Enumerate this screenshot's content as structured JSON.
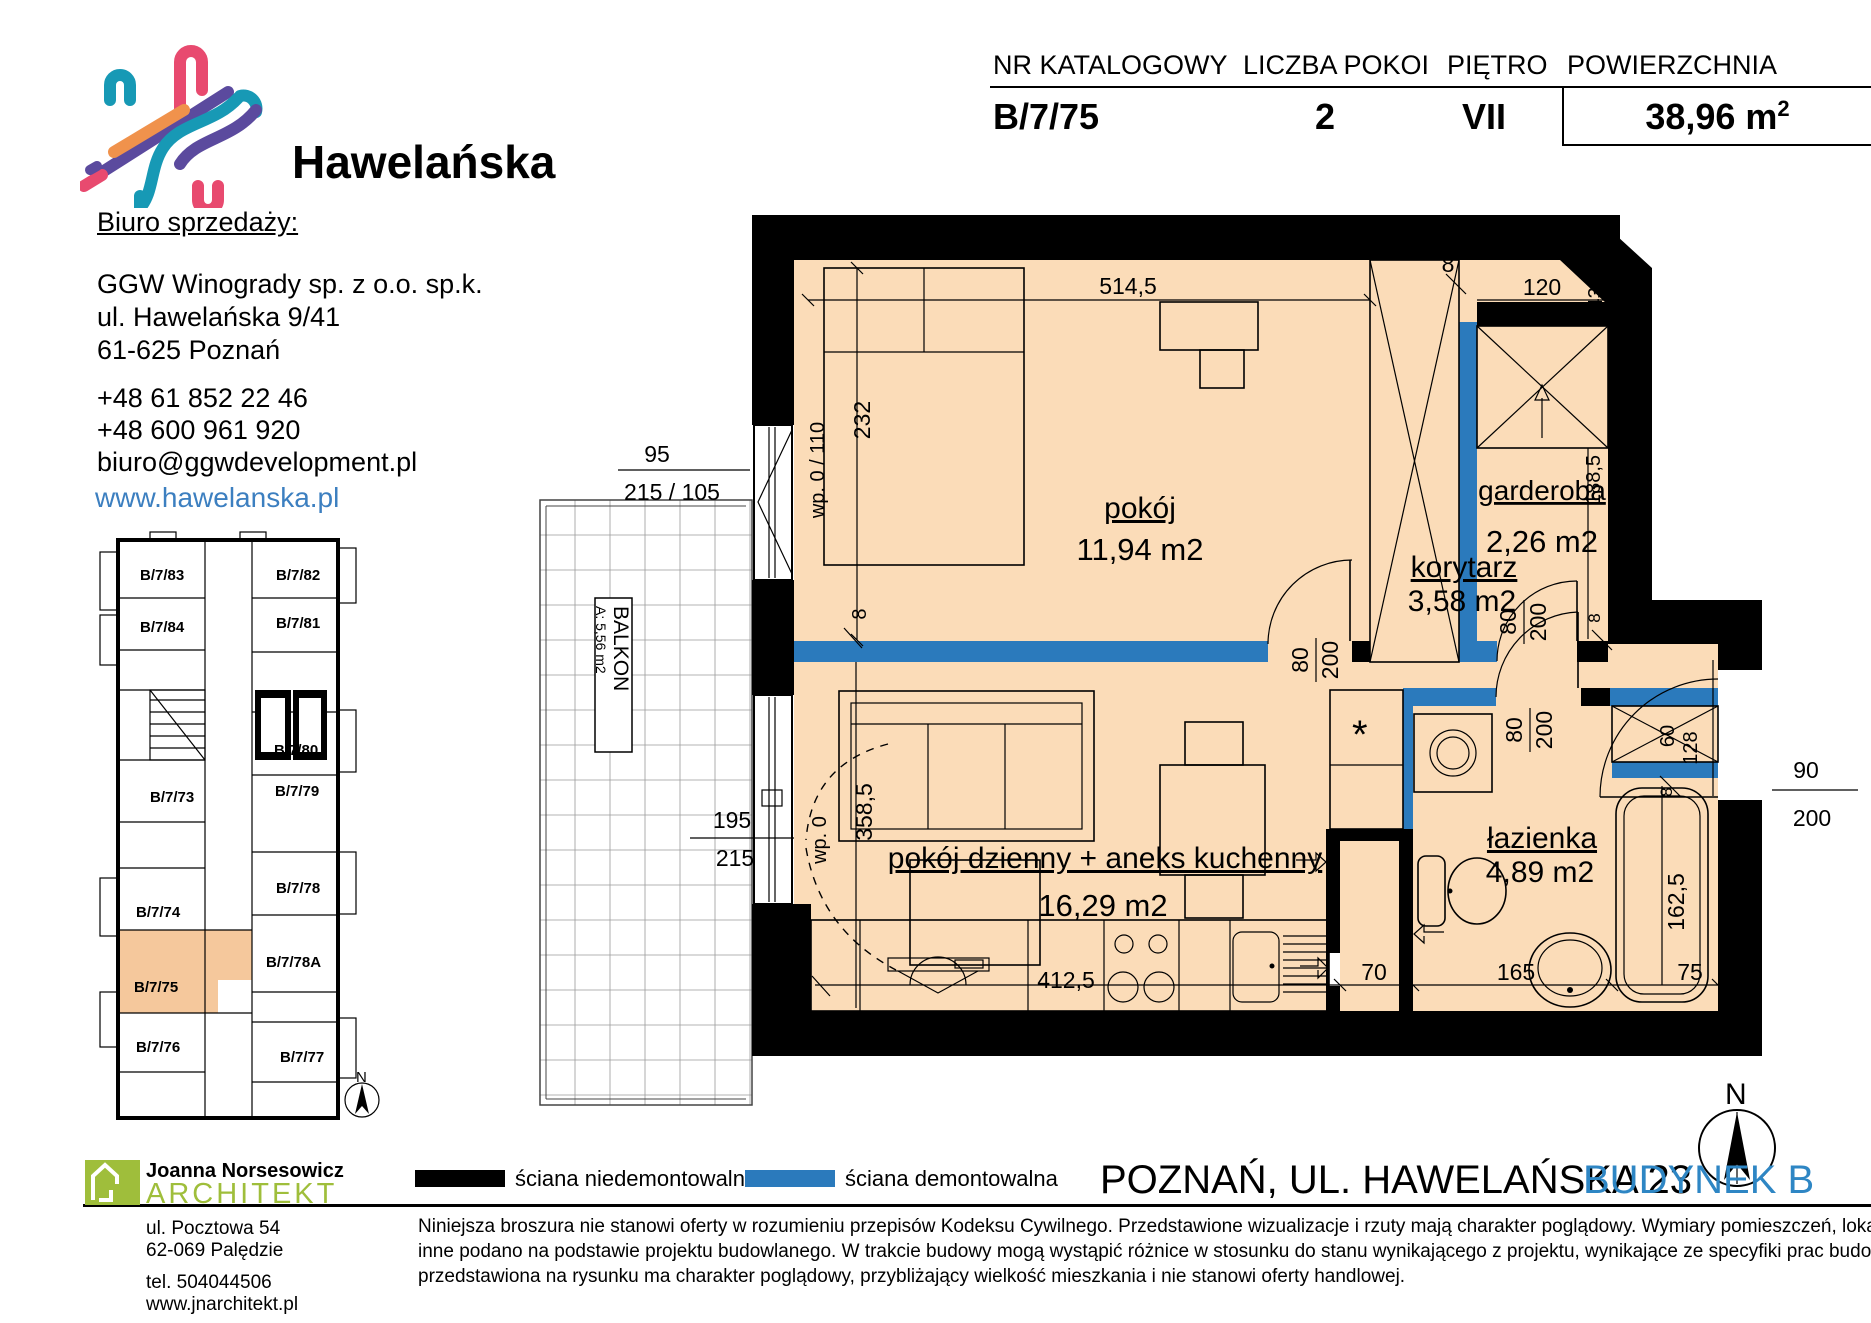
{
  "logo": {
    "brand": "Hawelańska"
  },
  "contact": {
    "heading": "Biuro sprzedaży:",
    "company": "GGW Winogrady sp. z o.o. sp.k.",
    "address1": "ul. Hawelańska 9/41",
    "address2": "61-625 Poznań",
    "phone1": "+48 61 852 22 46",
    "phone2": "+48 600 961 920",
    "email": "biuro@ggwdevelopment.pl",
    "website": "www.hawelanska.pl"
  },
  "header_table": {
    "columns": [
      "NR KATALOGOWY",
      "LICZBA POKOI",
      "PIĘTRO",
      "POWIERZCHNIA"
    ],
    "catalog_no": "B/7/75",
    "rooms": "2",
    "floor": "VII",
    "area": "38,96 m",
    "area_sup": "2"
  },
  "mini_plan": {
    "units": [
      "B/7/83",
      "B/7/82",
      "B/7/84",
      "B/7/81",
      "B/7/80",
      "B/7/73",
      "B/7/79",
      "B/7/78",
      "B/7/74",
      "B/7/78A",
      "B/7/75",
      "B/7/76",
      "B/7/77"
    ],
    "highlighted": "B/7/75",
    "compass": "N"
  },
  "floor_plan": {
    "rooms": [
      {
        "name": "pokój",
        "area": "11,94 m2"
      },
      {
        "name": "garderoba",
        "area": "2,26 m2"
      },
      {
        "name": "korytarz",
        "area": "3,58 m2"
      },
      {
        "name": "pokój dzienny + aneks kuchenny",
        "area": "16,29 m2"
      },
      {
        "name": "łazienka",
        "area": "4,89 m2"
      }
    ],
    "balcony": {
      "label": "BALKON",
      "area": "A: 5,56 m2"
    },
    "dims": {
      "d5145": "514,5",
      "d232": "232",
      "d8": "8",
      "d95": "95",
      "d215_105": "215 / 105",
      "wp0_110": "wp. 0 / 110",
      "d120": "120",
      "d43_5": "43,5",
      "d188_5": "188,5",
      "d80": "80",
      "d200": "200",
      "d90": "90",
      "d128": "128",
      "d358_5": "358,5",
      "wp0": "wp. 0",
      "d195": "195",
      "d215": "215",
      "d412_5": "412,5",
      "d70": "70",
      "d165": "165",
      "d75": "75",
      "d162_5": "162,5",
      "d60": "60"
    },
    "compass": "N"
  },
  "legend": {
    "solid": "ściana niedemontowalna",
    "demolishable": "ściana demontowalna",
    "solid_color": "#000000",
    "demolishable_color": "#2b7abc"
  },
  "footer": {
    "title": "POZNAŃ, UL. HAWELAŃSKA 23",
    "building": "BUDYNEK B",
    "disclaimer1": "Niniejsza broszura nie stanowi oferty w rozumieniu przepisów Kodeksu Cywilnego. Przedstawione wizualizacje i rzuty mają charakter poglądowy. Wymiary pomieszczeń, lokalizację przyborów sanitarnych i",
    "disclaimer2": "inne podano na podstawie projektu budowlanego. W trakcie budowy mogą wystąpić różnice w stosunku do stanu wynikającego z projektu, wynikające ze specyfiki prac budowlanych. Aranżacja mieszkania",
    "disclaimer3": "przedstawiona na rysunku ma charakter poglądowy, przybliżający wielkość mieszkania i nie stanowi oferty handlowej."
  },
  "architect": {
    "name": "Joanna Norsesowicz",
    "title": "ARCHITEKT",
    "address1": "ul. Pocztowa 54",
    "address2": "62-069 Palędzie",
    "phone": "tel. 504044506",
    "website": "www.jnarchitekt.pl"
  },
  "colors": {
    "floor": "#fbdcb8",
    "highlight": "#f5c89c",
    "accent_teal": "#1799b5",
    "blue_wall": "#2b7abc",
    "link_blue": "#3c7fc0",
    "brand_green": "#9fbe3b",
    "budynek_blue": "#2e86c4"
  }
}
